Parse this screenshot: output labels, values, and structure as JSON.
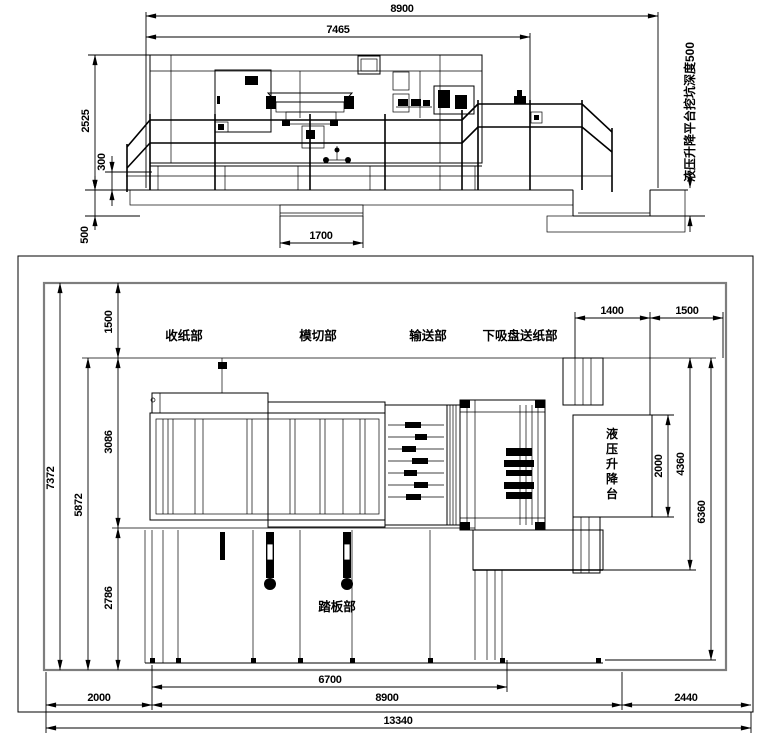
{
  "side_view": {
    "dims": {
      "total_length": "8900",
      "machine_length": "7465",
      "height": "2525",
      "base_height": "300",
      "pit_depth": "500",
      "pit_width": "1700"
    },
    "note": "液压升降平台挖坑深度500"
  },
  "plan_view": {
    "labels": {
      "delivery": "收纸部",
      "die_cutting": "模切部",
      "conveying": "输送部",
      "feeder": "下吸盘送纸部",
      "pedal": "踏板部",
      "lift_table": "液压升降台"
    },
    "lift_chars": [
      "液",
      "压",
      "升",
      "降",
      "台"
    ],
    "dims": {
      "site_width": "7372",
      "machine_width": "5872",
      "rear_margin": "1500",
      "machine_frame": "3086",
      "front_zone": "2786",
      "lift_a": "1400",
      "lift_b": "1500",
      "lift_length": "2000",
      "right_a": "4360",
      "right_b": "6360",
      "pedal_length": "6700",
      "left_margin": "2000",
      "machine_length": "8900",
      "right_margin": "2440",
      "total_length": "13340"
    }
  }
}
